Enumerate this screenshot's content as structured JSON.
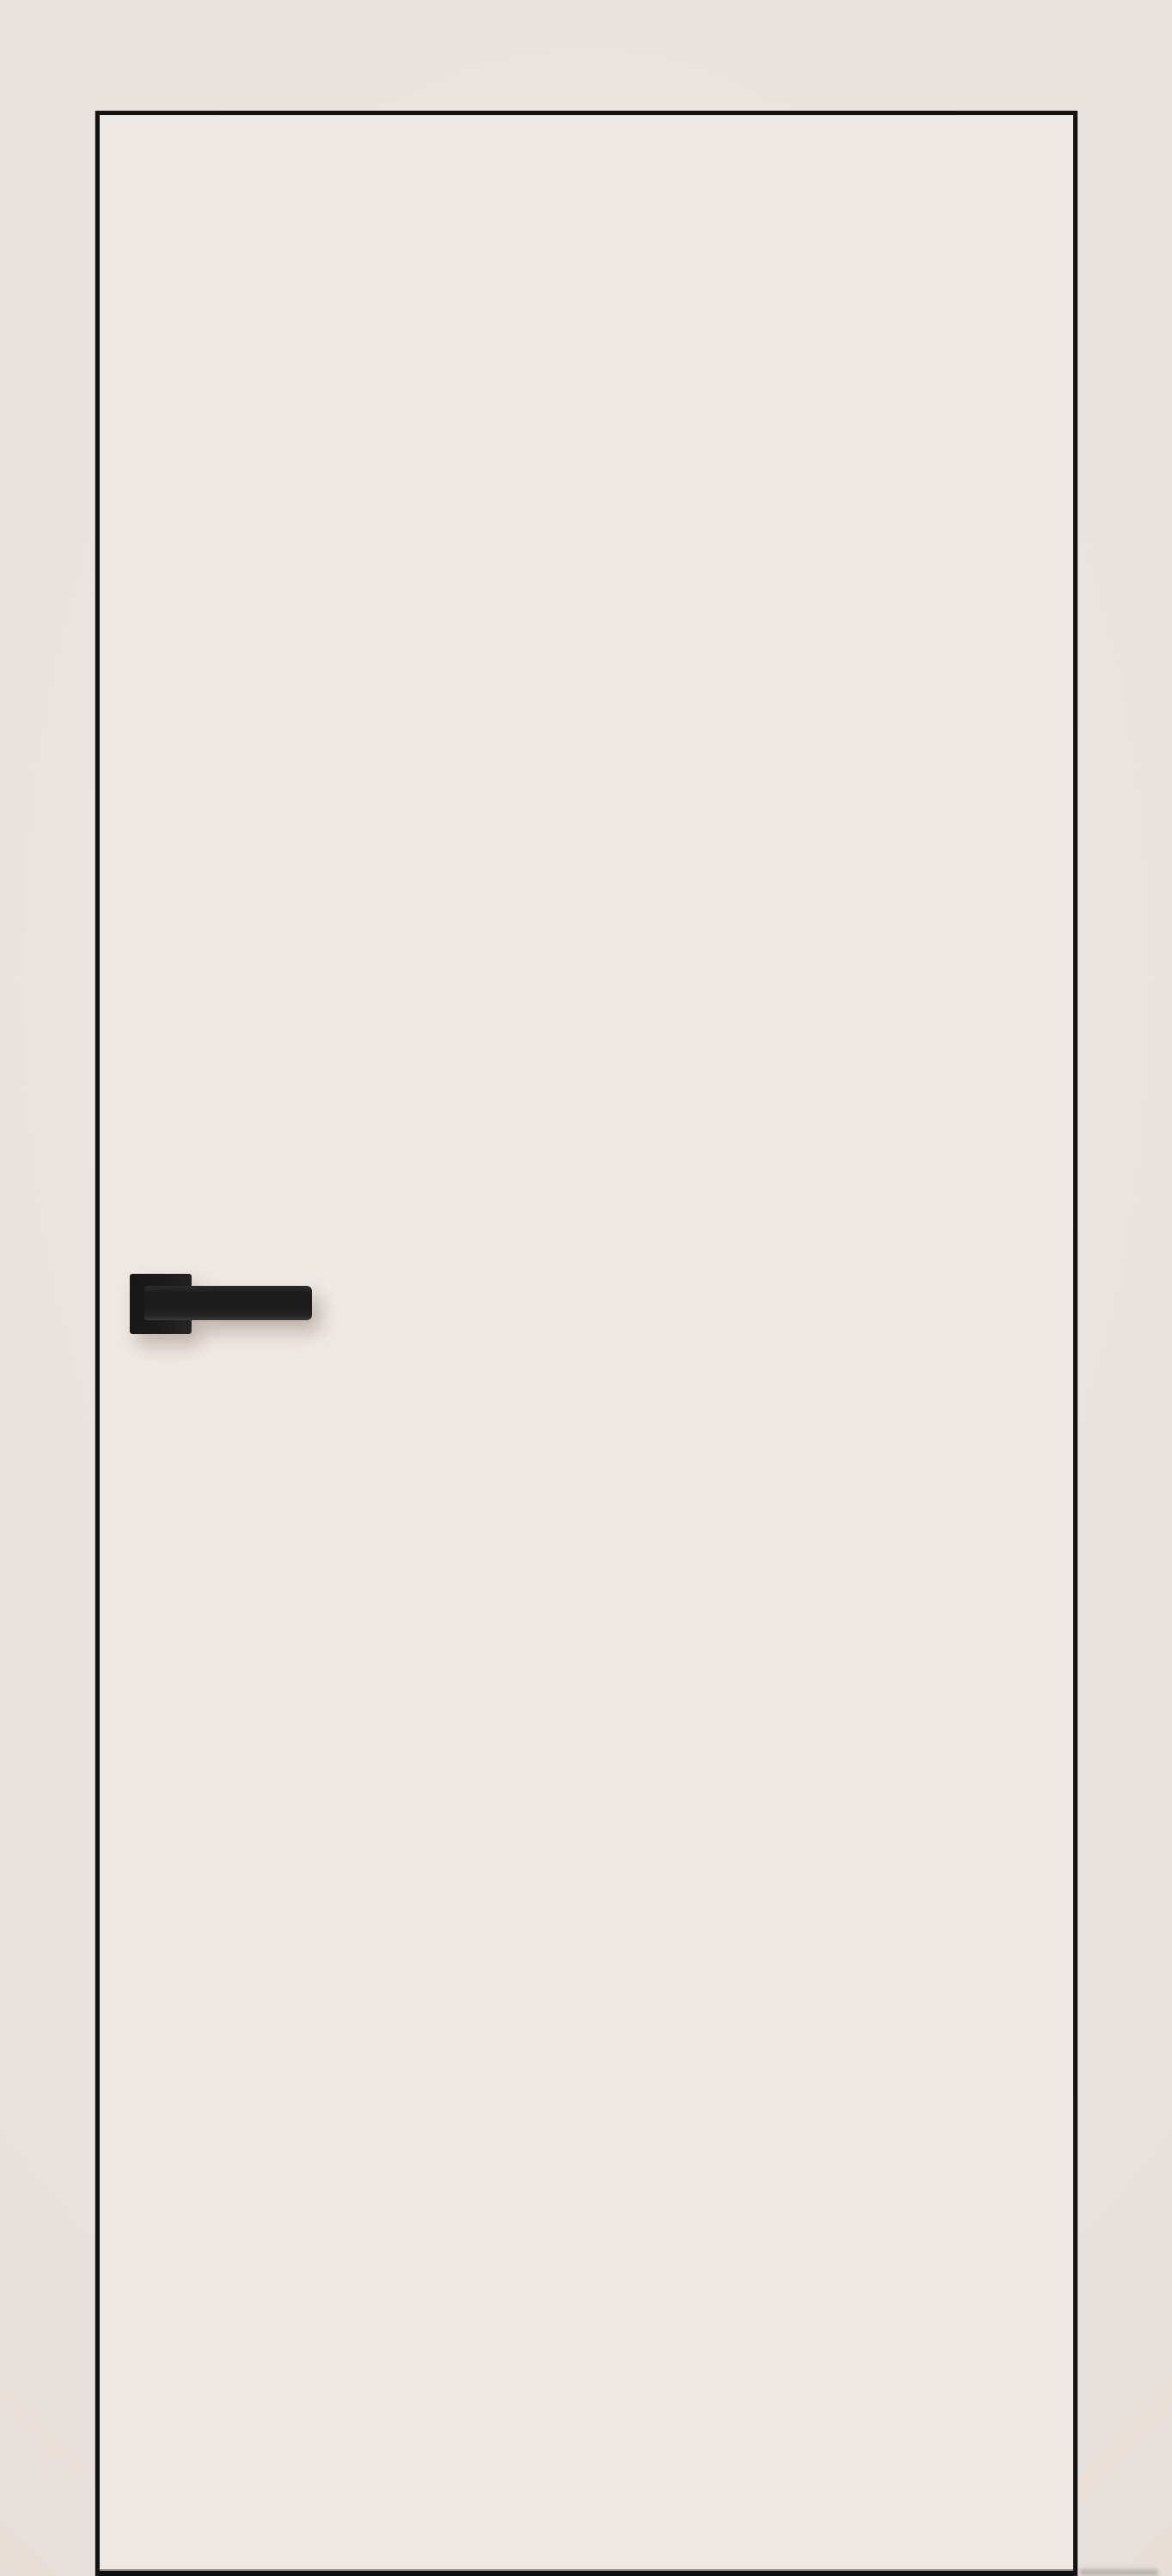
{
  "scene": {
    "type": "product-photo",
    "subject": "flush frameless interior door leaf, ivory finish, with matte black square-rosette lever handle on the left side and dark under-door gap at the floor",
    "door": {
      "outline_corner_top_left": "113,131",
      "outline_corner_top_right": "1251,131",
      "handle_side": "left",
      "handle_style": "square rosette with straight bar lever pointing right"
    },
    "colors": {
      "background": "#EAE2DC",
      "door_fill": "#EFE7E1",
      "door_outline": "#131313",
      "handle_black": "#1C1C1C",
      "bottom_gap_black": "#0E0E0E",
      "bottom_gap_highlight": "#9A918B",
      "soft_shadow": "rgba(118,98,86,0.38)"
    }
  }
}
